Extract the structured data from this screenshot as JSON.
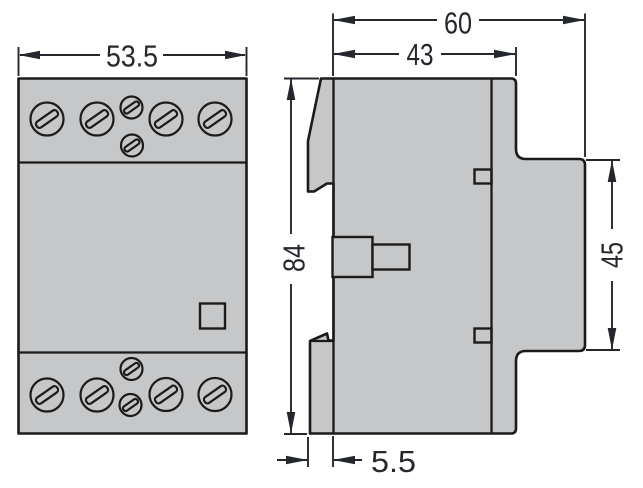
{
  "front_view": {
    "width_label": "53.5"
  },
  "side_view": {
    "overall_depth_label": "60",
    "upper_body_depth_label": "43",
    "height_label": "84",
    "rail_face_height_label": "45",
    "clip_offset_label": "5.5"
  },
  "colors": {
    "body_fill": "#c6c7c9",
    "outline": "#1b1b1b",
    "dimension_ink": "#24272c",
    "background": "#ffffff"
  }
}
